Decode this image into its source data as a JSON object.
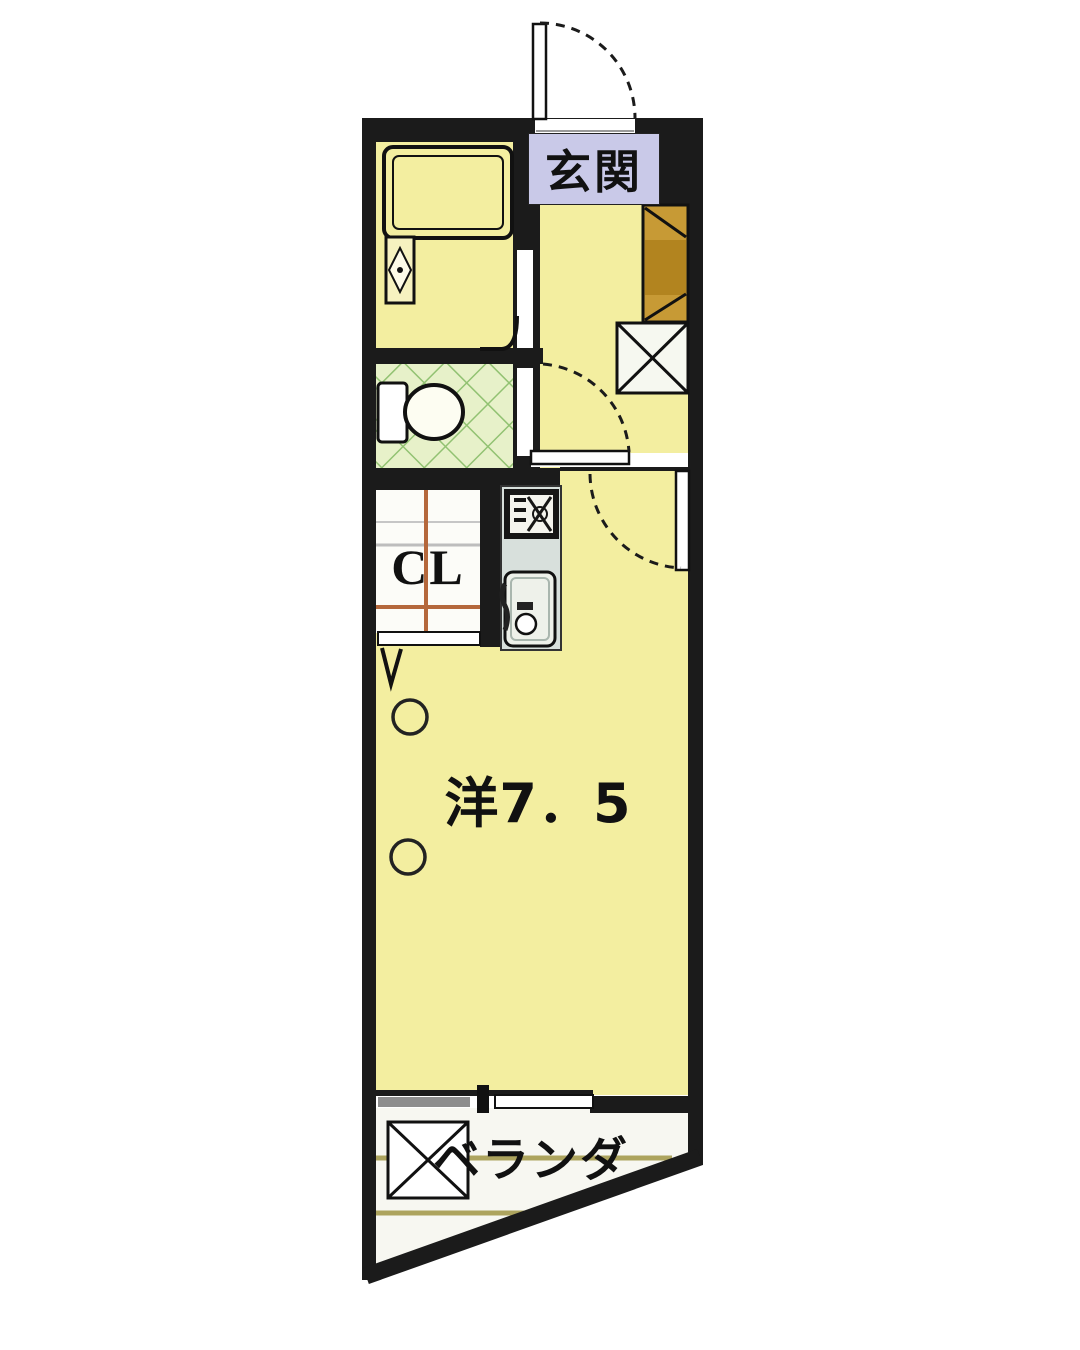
{
  "floorplan": {
    "labels": {
      "genkan": "玄関",
      "room": "洋7．5",
      "closet": "CL",
      "veranda": "ベランダ"
    },
    "colors": {
      "outside": "#ffffff",
      "wall": "#1b1b1b",
      "floor_yellow": "#f3eea0",
      "tile_bg": "#e7f1c9",
      "tile_line": "#92c272",
      "label_bg": "#c9c9e8",
      "cabinet_brown": "#c79a35",
      "cabinet_dark": "#b2841f",
      "counter_gray": "#d8e0dc",
      "sink_white": "#eef1ea",
      "window_gray": "#8d8d8d",
      "veranda_floor": "#f7f7f1",
      "veranda_line": "#ada45e"
    }
  }
}
